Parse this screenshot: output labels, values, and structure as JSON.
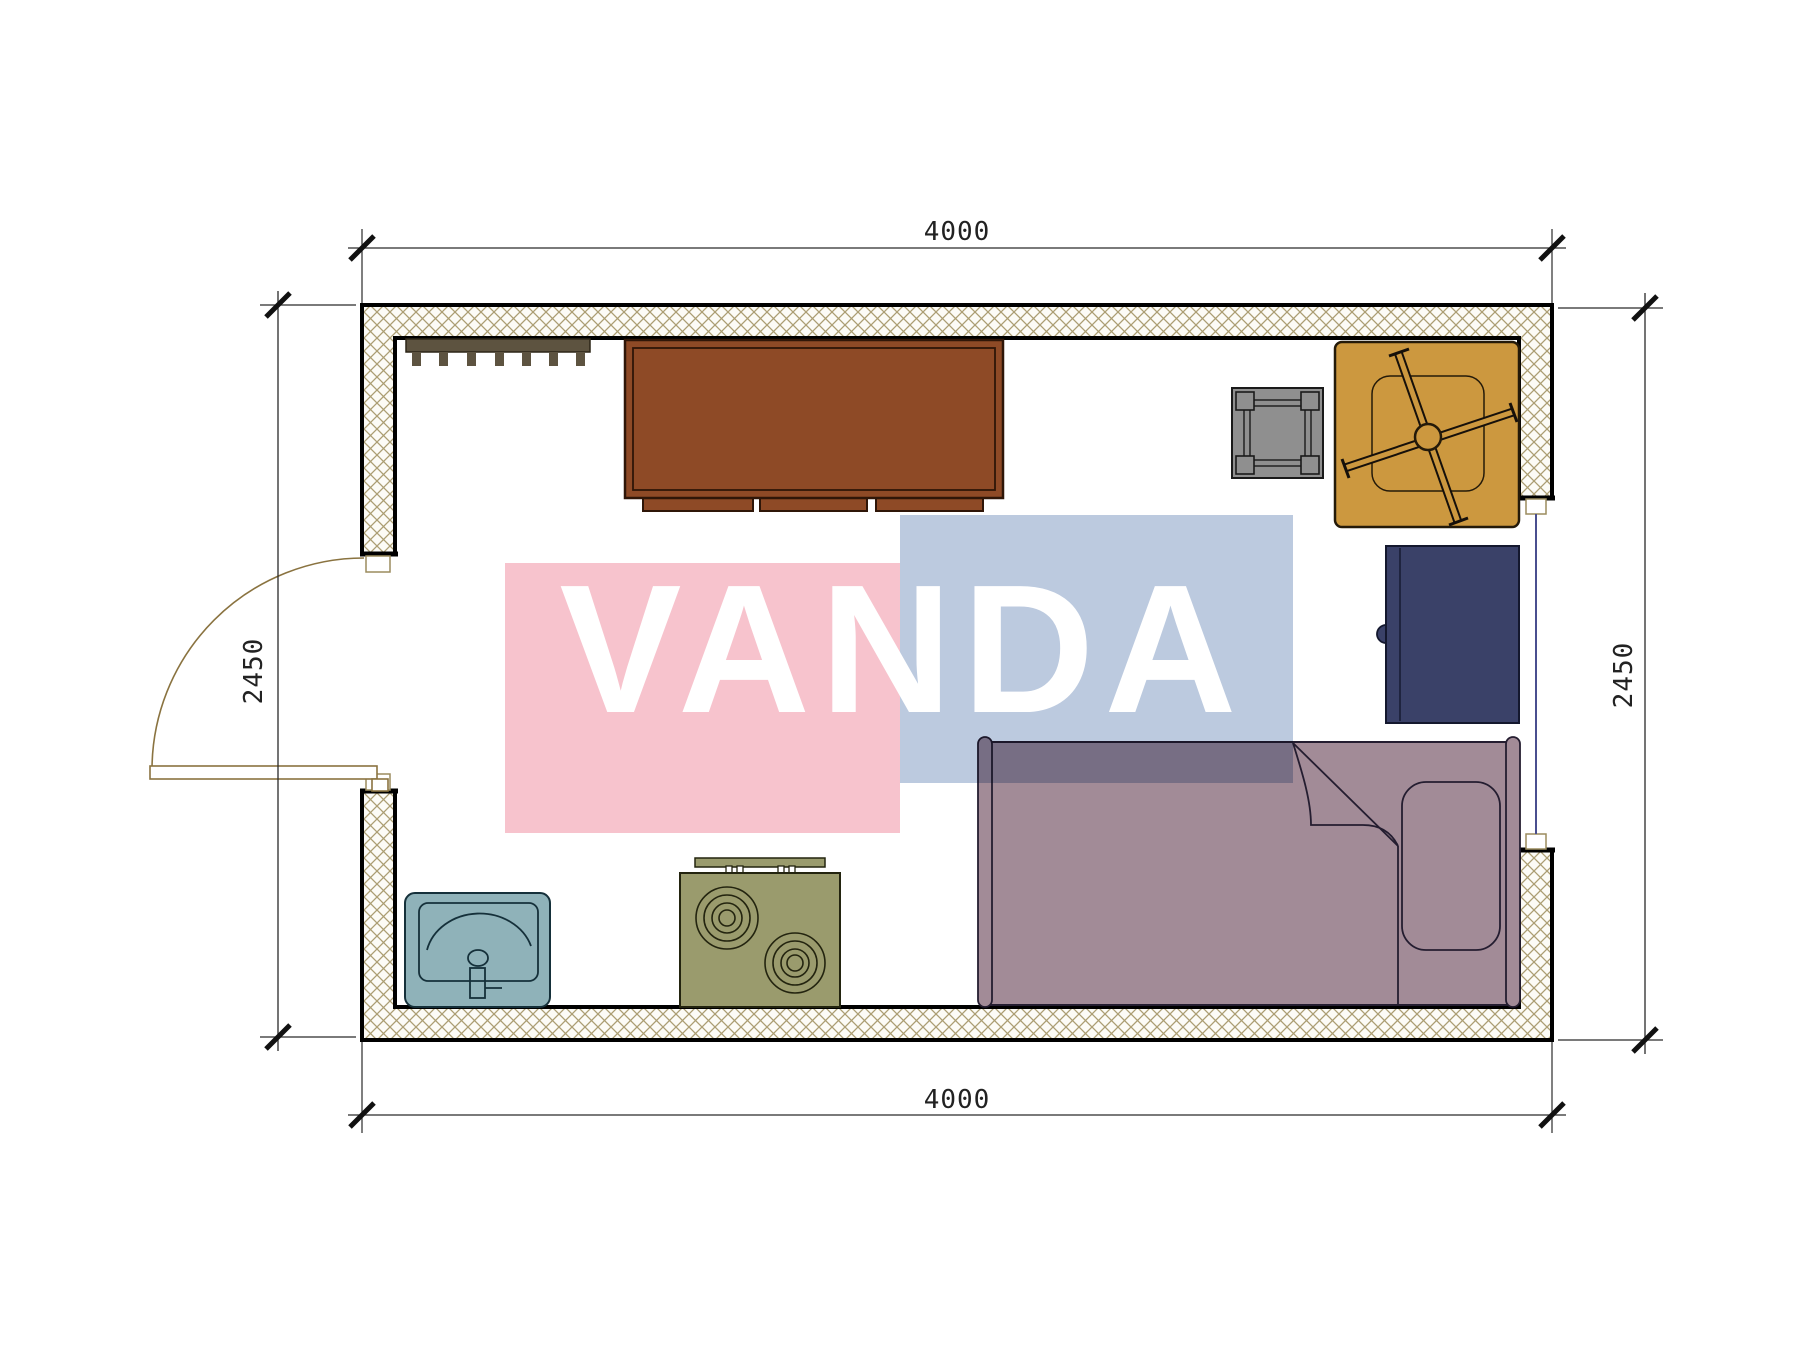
{
  "plan": {
    "type": "floor-plan",
    "dimensions": {
      "top": "4000",
      "bottom": "4000",
      "left": "2450",
      "right": "2450"
    }
  },
  "watermark": {
    "text": "VANDA",
    "pink": "#f7c3cd",
    "blue": "#bccadf",
    "text_color": "#ffffff"
  },
  "colors": {
    "wall_hatch_line": "#ab9d72",
    "wall_fill": "#fcfbf6",
    "door": "#8a7340",
    "window_glass": "#4a4f8f",
    "coat_rack": "#5d5340",
    "coat_rack_outline": "#2c2517",
    "cabinet": "#8e4a26",
    "cabinet_outline": "#2f1608",
    "stool": "#8f8f8f",
    "stool_outline": "#1a1a1a",
    "table": "#cc983f",
    "table_outline": "#241a09",
    "fridge": "#3a4168",
    "fridge_outline": "#14182e",
    "bed": "#a28b97",
    "bed_outline": "#241d30",
    "sink": "#8fb2b9",
    "sink_outline": "#15303a",
    "stove": "#9a9b6d",
    "stove_outline": "#23240f"
  },
  "furniture": {
    "items": [
      {
        "name": "coat-rack"
      },
      {
        "name": "cabinet"
      },
      {
        "name": "stool"
      },
      {
        "name": "pedestal-table"
      },
      {
        "name": "mini-fridge"
      },
      {
        "name": "single-bed"
      },
      {
        "name": "sink"
      },
      {
        "name": "stove"
      },
      {
        "name": "entry-door"
      },
      {
        "name": "window"
      }
    ]
  }
}
